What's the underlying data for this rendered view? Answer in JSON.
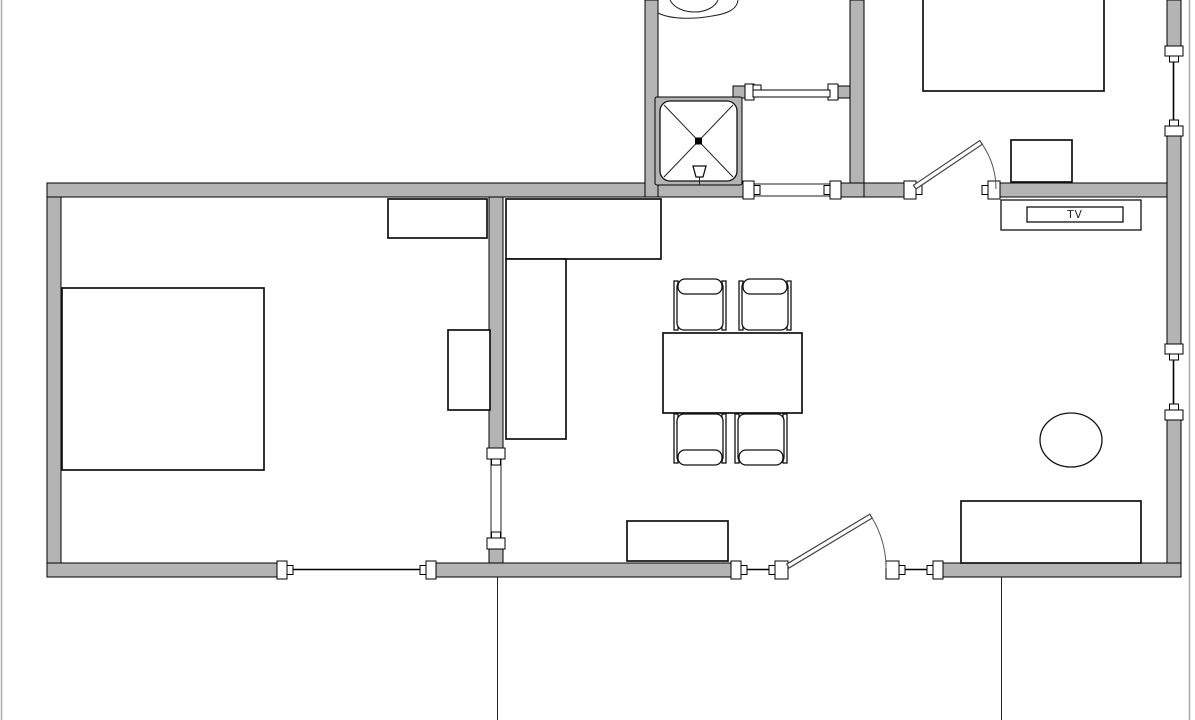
{
  "canvas": {
    "width": 1195,
    "height": 720,
    "background": "#ffffff",
    "frame_border_color": "#aaaaaa"
  },
  "palette": {
    "wall_fill": "#b4b4b4",
    "wall_outline": "#000000",
    "furniture_fill": "#ffffff",
    "furniture_outline": "#111111",
    "door_stroke": "#555555"
  },
  "labels": {
    "tv": "TV"
  },
  "plan": {
    "type": "apartment-floor-plan",
    "rooms_visible": [
      "bedroom-bottom-left",
      "open-kitchen-dining-living",
      "bathroom-with-shower-and-toilet (cut off at top)",
      "bedroom-top-right (cut off at top)",
      "hall-vestibule-beside-shower"
    ],
    "furniture": [
      "double-bed bottom-left room",
      "dresser on top wall of left room",
      "desk against partition wall of left room",
      "l-shaped kitchen counter",
      "dining-table",
      "dining-chair x4",
      "sideboard on bottom wall",
      "sofa bottom-right",
      "oval-side-table",
      "tv-cabinet with TV screen",
      "nightstand top-right room",
      "double-bed top-right room (cut off)",
      "shower-cabin with x-tray and shower head",
      "toilet (cut off at top edge)"
    ],
    "doors": [
      "sliding-door on bathroom partition",
      "hinged-door into top-right bedroom",
      "hinged-door to terrace in bottom wall",
      "wall-opening hall-to-living-room",
      "wall-opening into left bedroom"
    ],
    "windows": [
      "window in bottom wall of left bedroom",
      "window left of terrace door",
      "window right of terrace door",
      "window upper part of right wall",
      "window lower part of right wall"
    ],
    "exterior": [
      "vertical line below bottom wall at left of terrace",
      "vertical line below bottom wall at right of terrace"
    ]
  }
}
